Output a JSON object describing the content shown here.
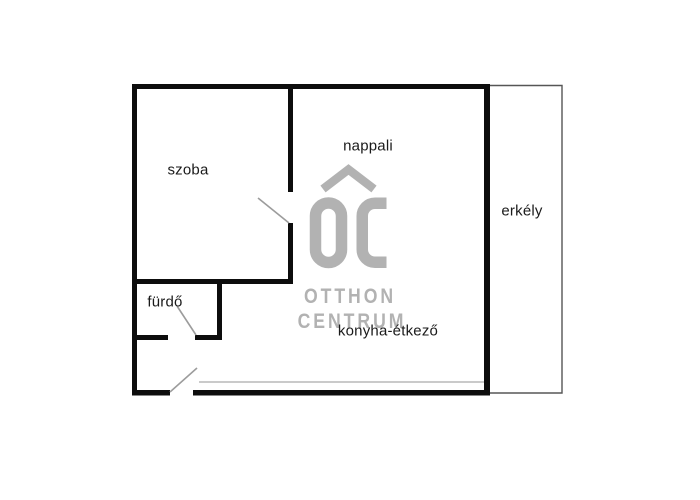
{
  "title": "apartment floor plan",
  "rooms": {
    "szoba": "szoba",
    "nappali": "nappali",
    "erkely": "erkély",
    "furdo": "fürdő",
    "konyha": "konyha-étkező"
  },
  "watermark": {
    "monogram": "OC",
    "line1": "OTTHON",
    "line2": "CENTRUM"
  },
  "colors": {
    "background": "#ffffff",
    "wall": "#0d0d0d",
    "door": "#9c9c9c",
    "thin": "#565656",
    "sill": "#ababab",
    "label": "#1a1a1a",
    "watermark": "#b2b2b2"
  }
}
